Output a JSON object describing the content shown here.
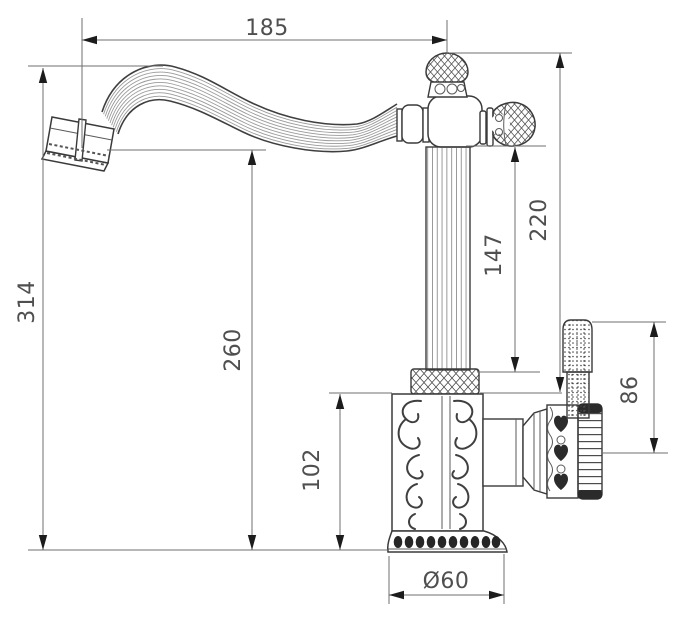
{
  "drawing": {
    "background": "#ffffff",
    "line_color": "#3a3a3a",
    "dimension_color": "#4f4f4f",
    "units": "mm"
  },
  "dimensions": {
    "spout_reach": "185",
    "overall_height": "314",
    "spout_outlet_height": "260",
    "top_height": "220",
    "handle_clearance": "147",
    "side_handle_height": "86",
    "body_height": "102",
    "base_diameter": "Ø60"
  }
}
